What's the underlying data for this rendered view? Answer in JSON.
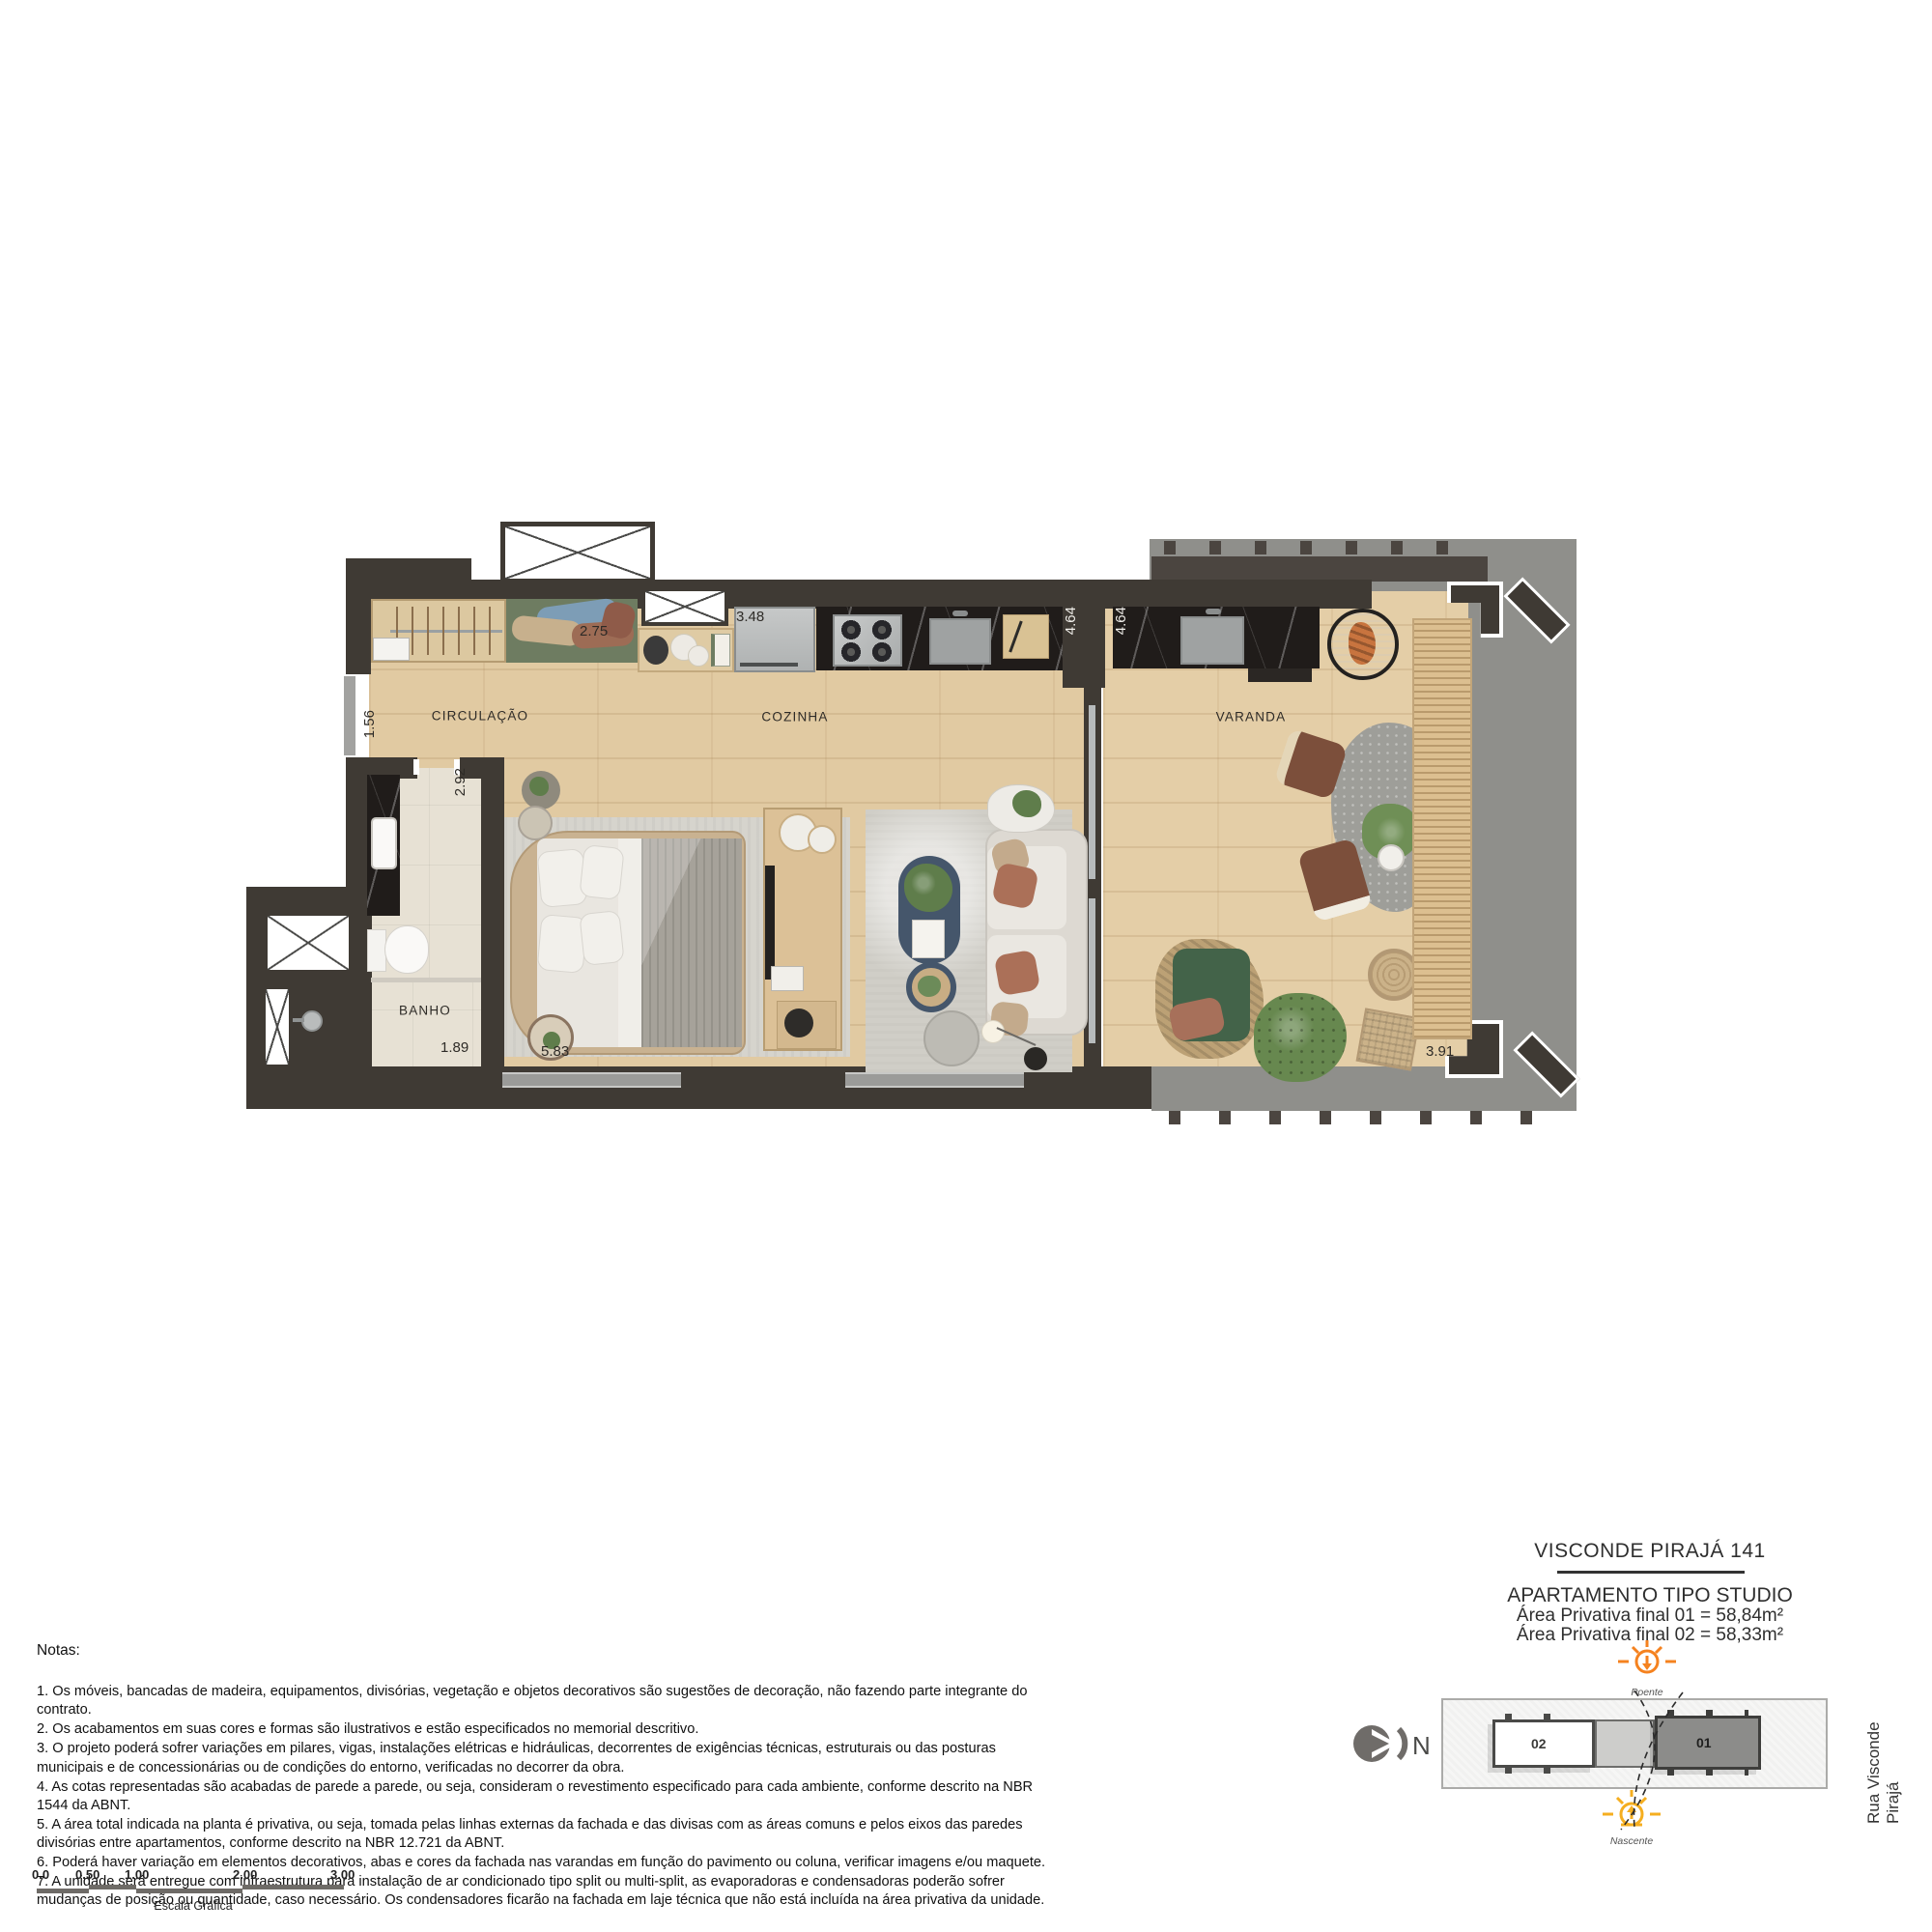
{
  "colors": {
    "wall": "#3F3A34",
    "sun_accent": "#F5821F",
    "wood": "#E1CAA2",
    "slab": "#8F8F8B"
  },
  "plan": {
    "rooms": {
      "circulacao": "CIRCULAÇÃO",
      "cozinha": "COZINHA",
      "varanda": "VARANDA",
      "banho": "BANHO"
    },
    "dims": {
      "shelf_width": "2.75",
      "counter_width": "3.48",
      "kitchen_depth": "4.64",
      "varanda_depth": "4.64",
      "entry_width": "1.56",
      "bath_width": "2.92",
      "shower_width": "1.89",
      "bedroom_width": "5.83",
      "varanda_width": "3.91"
    }
  },
  "title_block": {
    "project": "VISCONDE PIRAJÁ 141",
    "unit_type": "APARTAMENTO TIPO STUDIO",
    "area_01": "Área Privativa final 01 = 58,84m²",
    "area_02": "Área Privativa final 02 = 58,33m²"
  },
  "orientation": {
    "north": "N",
    "poente": "Poente",
    "nascente": "Nascente",
    "street": "Rua Visconde Pirajá"
  },
  "key_plan": {
    "unit_01": "01",
    "unit_02": "02"
  },
  "notes": {
    "heading": "Notas:",
    "items": [
      "1. Os móveis, bancadas de madeira, equipamentos, divisórias, vegetação e objetos decorativos são sugestões de decoração, não fazendo parte integrante do contrato.",
      "2. Os acabamentos em suas cores e formas são ilustrativos e estão especificados no memorial descritivo.",
      "3. O projeto poderá sofrer variações em pilares, vigas, instalações elétricas e hidráulicas, decorrentes de exigências técnicas, estruturais ou das posturas municipais e de concessionárias ou de condições do entorno, verificadas no decorrer da obra.",
      "4. As cotas representadas são acabadas de parede a parede, ou seja, consideram o revestimento especificado para cada ambiente, conforme descrito na NBR 1544 da ABNT.",
      "5. A área total indicada na planta é privativa, ou seja, tomada pelas linhas externas da fachada e das divisas com as áreas comuns e pelos eixos das paredes divisórias entre apartamentos, conforme descrito na NBR 12.721 da ABNT.",
      "6. Poderá haver variação em elementos decorativos, abas e cores da fachada nas varandas em função do pavimento ou coluna, verificar imagens e/ou maquete.",
      "7. A unidade será entregue com infraestrutura para instalação de ar condicionado tipo split ou multi-split, as evaporadoras e condensadoras poderão sofrer mudanças de posição ou quantidade, caso necessário. Os condensadores ficarão na fachada em laje técnica que não está incluída na área privativa da unidade."
    ]
  },
  "scale_bar": {
    "ticks": [
      "0.0",
      "0.50",
      "1.00",
      "2.00",
      "3.00"
    ],
    "caption": "Escala Gráfica"
  }
}
